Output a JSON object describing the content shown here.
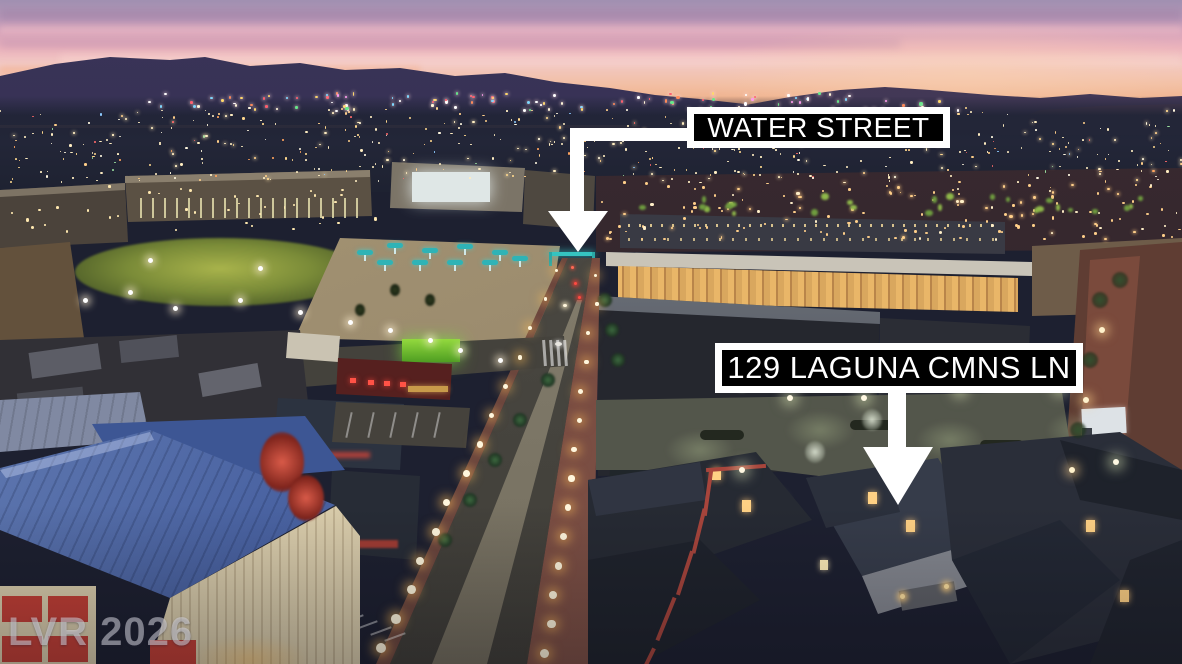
{
  "annotations": {
    "street_label": {
      "text": "WATER STREET"
    },
    "property_label": {
      "text": "129 LAGUNA CMNS LN"
    },
    "watermark": {
      "text": "LVR 2026"
    }
  },
  "palette": {
    "label_background": "#000000",
    "label_frame": "#ffffff",
    "label_text": "#ffffff",
    "arrow": "#ffffff",
    "sky_top": "#a090b1",
    "sky_pink": "#ecb4bd",
    "sky_horizon_orange": "#efae86",
    "mountain_silhouette": "#342f50",
    "distant_city_light": "#ffeec2",
    "street_lamp_glow": "#fff3d0",
    "blue_metal_roof": "#4a63a2",
    "green_storefront": "#7ac832",
    "red_building": "#56201f",
    "condo_roof": "#2a2e39",
    "watermark_color": "rgba(226,226,234,0.5)"
  }
}
